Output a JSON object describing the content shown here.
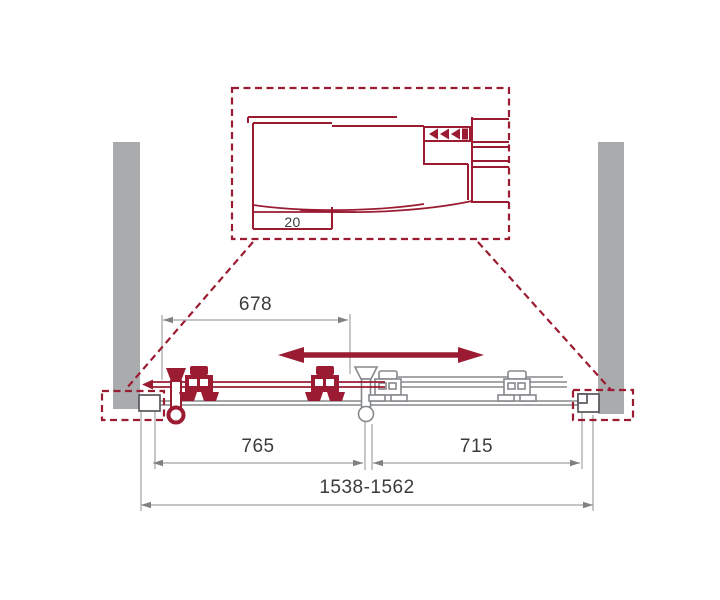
{
  "diagram": {
    "detail_view": {
      "profile_offset_label": "20"
    },
    "dimensions": {
      "track_width": "678",
      "sliding_panel_width": "765",
      "fixed_panel_width": "715",
      "overall_width": "1538-1562"
    }
  },
  "colors": {
    "accent_red": "#9A1B32",
    "wall_gray": "#A9ABAD",
    "part_gray": "#85888C",
    "profile_dark": "#55585B",
    "dim_line_gray": "#A0A2A5",
    "dim_arrow_gray": "#7E8184",
    "text_dark": "#3B3B3B",
    "background": "#FFFFFF"
  }
}
